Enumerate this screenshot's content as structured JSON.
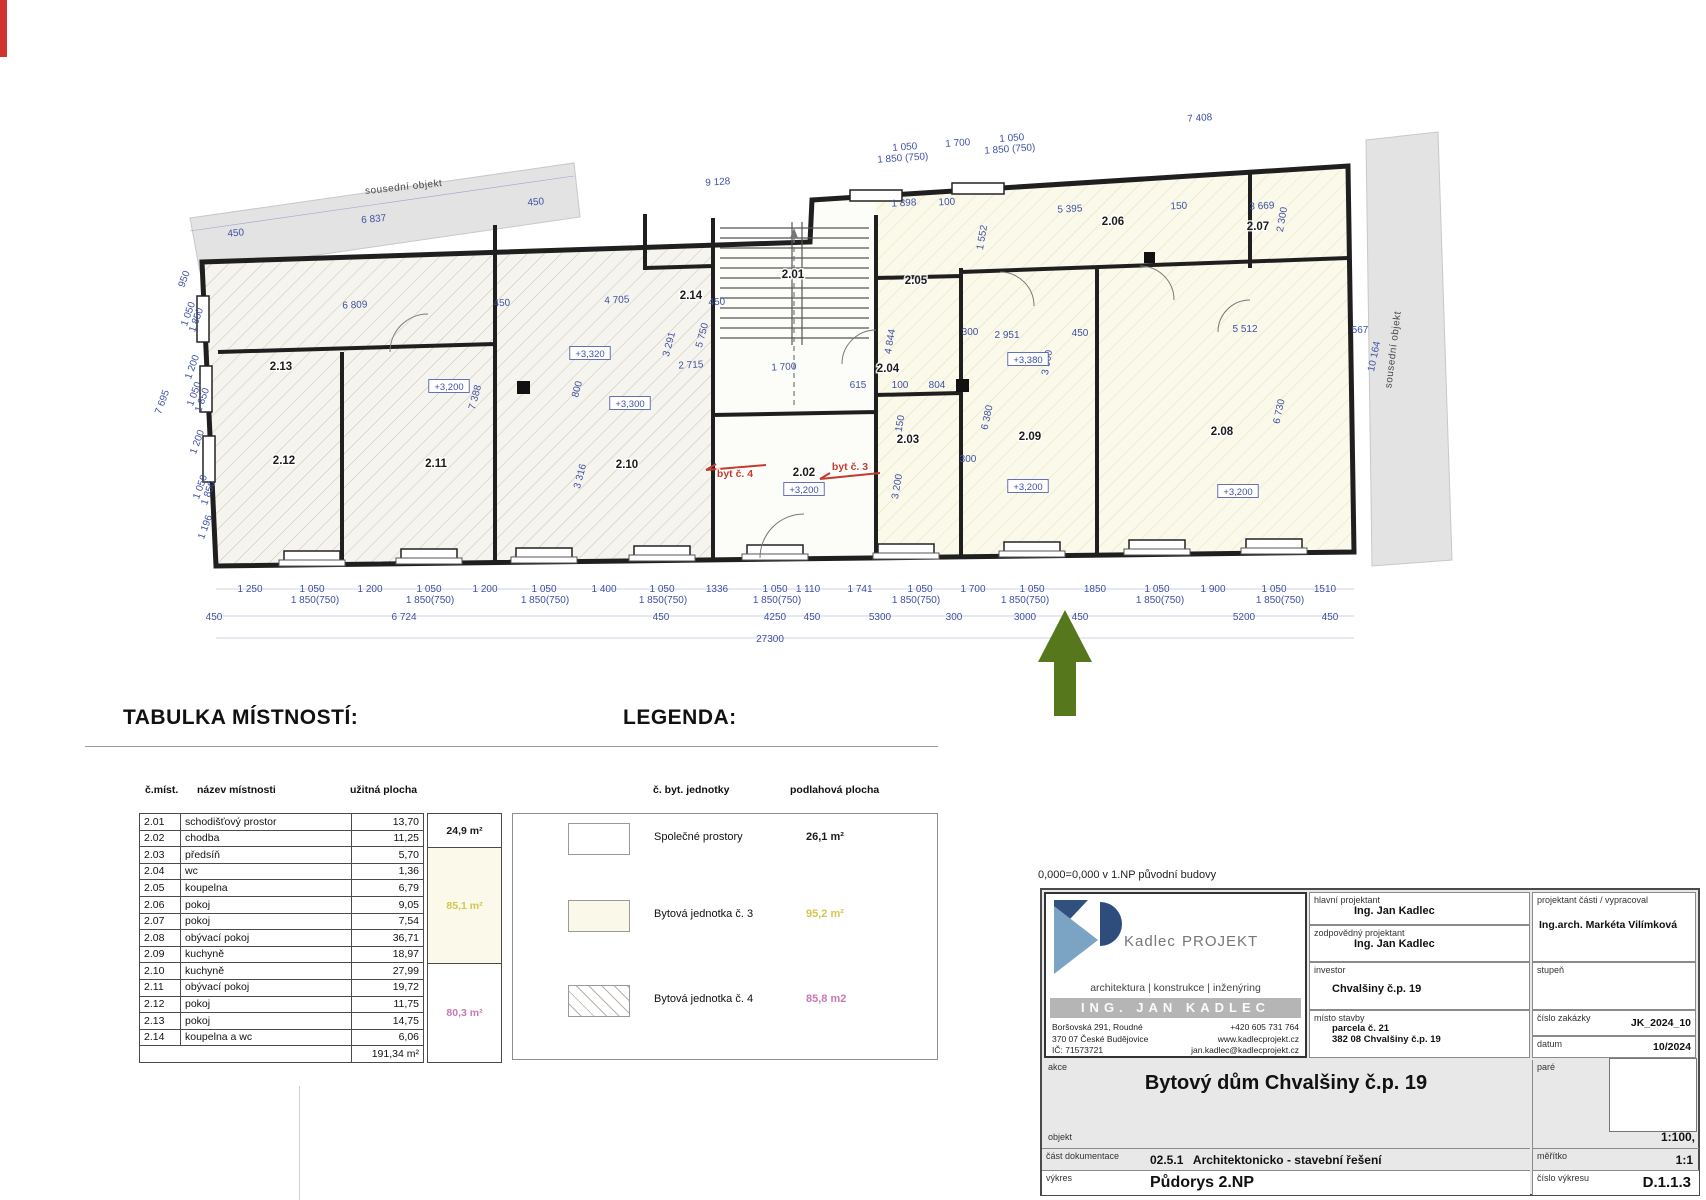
{
  "page": {
    "headings": {
      "table": "TABULKA MÍSTNOSTÍ:",
      "legend": "LEGENDA:"
    },
    "note": "0,000=0,000 v 1.NP původní budovy"
  },
  "plan": {
    "neighbors": [
      {
        "t": "sousední objekt",
        "x": 404,
        "y": 190,
        "r": -6
      },
      {
        "t": "sousední objekt",
        "x": 1396,
        "y": 350,
        "r": -83
      }
    ],
    "rooms": [
      {
        "t": "2.01",
        "x": 793,
        "y": 278
      },
      {
        "t": "2.02",
        "x": 804,
        "y": 476
      },
      {
        "t": "2.03",
        "x": 908,
        "y": 443
      },
      {
        "t": "2.04",
        "x": 888,
        "y": 372
      },
      {
        "t": "2.05",
        "x": 916,
        "y": 284
      },
      {
        "t": "2.06",
        "x": 1113,
        "y": 225
      },
      {
        "t": "2.07",
        "x": 1258,
        "y": 230
      },
      {
        "t": "2.08",
        "x": 1222,
        "y": 435
      },
      {
        "t": "2.09",
        "x": 1030,
        "y": 440
      },
      {
        "t": "2.10",
        "x": 627,
        "y": 468
      },
      {
        "t": "2.11",
        "x": 436,
        "y": 467
      },
      {
        "t": "2.12",
        "x": 284,
        "y": 464
      },
      {
        "t": "2.13",
        "x": 281,
        "y": 370
      },
      {
        "t": "2.14",
        "x": 691,
        "y": 299
      }
    ],
    "elevations": [
      {
        "t": "+3,200",
        "x": 449,
        "y": 390
      },
      {
        "t": "+3,320",
        "x": 590,
        "y": 357
      },
      {
        "t": "+3,300",
        "x": 630,
        "y": 407
      },
      {
        "t": "+3,200",
        "x": 804,
        "y": 493
      },
      {
        "t": "+3,380",
        "x": 1028,
        "y": 363
      },
      {
        "t": "+3,200",
        "x": 1028,
        "y": 490
      },
      {
        "t": "+3,200",
        "x": 1238,
        "y": 495
      }
    ],
    "units": [
      {
        "t": "byt č. 4",
        "x": 735,
        "y": 477
      },
      {
        "t": "byt č. 3",
        "x": 850,
        "y": 470
      }
    ],
    "dims": [
      {
        "t": "450",
        "x": 236,
        "y": 236,
        "r": -5,
        "s": 9
      },
      {
        "t": "6 837",
        "x": 374,
        "y": 222,
        "r": -5
      },
      {
        "t": "450",
        "x": 536,
        "y": 205,
        "r": -5,
        "s": 9
      },
      {
        "t": "9 128",
        "x": 718,
        "y": 185,
        "r": -4
      },
      {
        "t": "1 050",
        "x": 905,
        "y": 150,
        "r": -4,
        "s": 9
      },
      {
        "t": "1 850 (750)",
        "x": 903,
        "y": 161,
        "r": -4,
        "s": 8
      },
      {
        "t": "1 700",
        "x": 958,
        "y": 146,
        "r": -4,
        "s": 9
      },
      {
        "t": "1 050",
        "x": 1012,
        "y": 141,
        "r": -4,
        "s": 9
      },
      {
        "t": "1 850 (750)",
        "x": 1010,
        "y": 152,
        "r": -4,
        "s": 8
      },
      {
        "t": "7 408",
        "x": 1200,
        "y": 121,
        "r": -4
      },
      {
        "t": "1 898",
        "x": 904,
        "y": 206,
        "r": -3,
        "s": 9
      },
      {
        "t": "100",
        "x": 947,
        "y": 205,
        "r": -3,
        "s": 9
      },
      {
        "t": "5 395",
        "x": 1070,
        "y": 212,
        "r": -3
      },
      {
        "t": "150",
        "x": 1179,
        "y": 209,
        "r": -3,
        "s": 9
      },
      {
        "t": "3 669",
        "x": 1262,
        "y": 209,
        "r": -3
      },
      {
        "t": "2 300",
        "x": 1285,
        "y": 220,
        "r": -80,
        "s": 9
      },
      {
        "t": "1 552",
        "x": 985,
        "y": 238,
        "r": -80,
        "s": 9
      },
      {
        "t": "6 809",
        "x": 355,
        "y": 308,
        "r": -3
      },
      {
        "t": "450",
        "x": 502,
        "y": 306,
        "r": -3,
        "s": 9
      },
      {
        "t": "4 705",
        "x": 617,
        "y": 303,
        "r": -3
      },
      {
        "t": "450",
        "x": 717,
        "y": 305,
        "r": -3,
        "s": 9
      },
      {
        "t": "2 715",
        "x": 691,
        "y": 368,
        "r": -3
      },
      {
        "t": "1 700",
        "x": 784,
        "y": 370,
        "r": -3
      },
      {
        "t": "3 291",
        "x": 672,
        "y": 345,
        "r": -75,
        "s": 9
      },
      {
        "t": "5 750",
        "x": 705,
        "y": 336,
        "r": -75,
        "s": 9
      },
      {
        "t": "800",
        "x": 580,
        "y": 390,
        "r": -75,
        "s": 9
      },
      {
        "t": "7 388",
        "x": 478,
        "y": 398,
        "r": -75,
        "s": 9
      },
      {
        "t": "3 316",
        "x": 583,
        "y": 477,
        "r": -75,
        "s": 9
      },
      {
        "t": "615",
        "x": 858,
        "y": 388,
        "s": 9
      },
      {
        "t": "100",
        "x": 900,
        "y": 388,
        "s": 9
      },
      {
        "t": "804",
        "x": 937,
        "y": 388,
        "s": 9
      },
      {
        "t": "150",
        "x": 903,
        "y": 424,
        "r": -80,
        "s": 9
      },
      {
        "t": "4 844",
        "x": 893,
        "y": 342,
        "r": -80,
        "s": 9
      },
      {
        "t": "3 200",
        "x": 900,
        "y": 487,
        "r": -80,
        "s": 9
      },
      {
        "t": "300",
        "x": 970,
        "y": 335,
        "s": 9
      },
      {
        "t": "2 951",
        "x": 1007,
        "y": 338
      },
      {
        "t": "450",
        "x": 1080,
        "y": 336,
        "s": 9
      },
      {
        "t": "3 900",
        "x": 1050,
        "y": 363,
        "r": -80,
        "s": 9
      },
      {
        "t": "5 512",
        "x": 1245,
        "y": 332
      },
      {
        "t": "567",
        "x": 1360,
        "y": 333,
        "s": 9
      },
      {
        "t": "10 164",
        "x": 1377,
        "y": 357,
        "r": -78,
        "s": 9
      },
      {
        "t": "6 730",
        "x": 1282,
        "y": 412,
        "r": -78,
        "s": 9
      },
      {
        "t": "6 380",
        "x": 990,
        "y": 418,
        "r": -78,
        "s": 9
      },
      {
        "t": "300",
        "x": 968,
        "y": 462,
        "s": 9
      },
      {
        "t": "950",
        "x": 187,
        "y": 280,
        "r": -70,
        "s": 9
      },
      {
        "t": "1 050",
        "x": 191,
        "y": 315,
        "r": -70,
        "s": 9
      },
      {
        "t": "1 850",
        "x": 199,
        "y": 321,
        "r": -70,
        "s": 9
      },
      {
        "t": "1 200",
        "x": 195,
        "y": 368,
        "r": -70,
        "s": 9
      },
      {
        "t": "1 050",
        "x": 197,
        "y": 395,
        "r": -70,
        "s": 9
      },
      {
        "t": "1 850",
        "x": 205,
        "y": 401,
        "r": -70,
        "s": 9
      },
      {
        "t": "7 695",
        "x": 165,
        "y": 403,
        "r": -70,
        "s": 9
      },
      {
        "t": "1 200",
        "x": 200,
        "y": 443,
        "r": -70,
        "s": 9
      },
      {
        "t": "1 050",
        "x": 203,
        "y": 488,
        "r": -70,
        "s": 9
      },
      {
        "t": "1 850",
        "x": 211,
        "y": 494,
        "r": -70,
        "s": 9
      },
      {
        "t": "1 196",
        "x": 208,
        "y": 528,
        "r": -70,
        "s": 9
      },
      {
        "t": "1 250",
        "x": 250,
        "y": 592,
        "s": 9.5
      },
      {
        "t": "1 050",
        "x": 312,
        "y": 592,
        "s": 9.5
      },
      {
        "t": "1 200",
        "x": 370,
        "y": 592,
        "s": 9.5
      },
      {
        "t": "1 050",
        "x": 429,
        "y": 592,
        "s": 9.5
      },
      {
        "t": "1 200",
        "x": 485,
        "y": 592,
        "s": 9.5
      },
      {
        "t": "1 050",
        "x": 544,
        "y": 592,
        "s": 9.5
      },
      {
        "t": "1 400",
        "x": 604,
        "y": 592,
        "s": 9.5
      },
      {
        "t": "1 050",
        "x": 662,
        "y": 592,
        "s": 9.5
      },
      {
        "t": "1336",
        "x": 717,
        "y": 592,
        "s": 9.5
      },
      {
        "t": "1 050",
        "x": 775,
        "y": 592,
        "s": 9.5
      },
      {
        "t": "1 110",
        "x": 808,
        "y": 592,
        "s": 9.5
      },
      {
        "t": "1 741",
        "x": 860,
        "y": 592,
        "s": 9.5
      },
      {
        "t": "1 050",
        "x": 920,
        "y": 592,
        "s": 9.5
      },
      {
        "t": "1 700",
        "x": 973,
        "y": 592,
        "s": 9.5
      },
      {
        "t": "1 050",
        "x": 1032,
        "y": 592,
        "s": 9.5
      },
      {
        "t": "1850",
        "x": 1095,
        "y": 592,
        "s": 9.5
      },
      {
        "t": "1 050",
        "x": 1157,
        "y": 592,
        "s": 9.5
      },
      {
        "t": "1 900",
        "x": 1213,
        "y": 592,
        "s": 9.5
      },
      {
        "t": "1 050",
        "x": 1274,
        "y": 592,
        "s": 9.5
      },
      {
        "t": "1510",
        "x": 1325,
        "y": 592,
        "s": 9.5
      },
      {
        "t": "1 850(750)",
        "x": 315,
        "y": 603,
        "s": 8
      },
      {
        "t": "1 850(750)",
        "x": 430,
        "y": 603,
        "s": 8
      },
      {
        "t": "1 850(750)",
        "x": 545,
        "y": 603,
        "s": 8
      },
      {
        "t": "1 850(750)",
        "x": 663,
        "y": 603,
        "s": 8
      },
      {
        "t": "1 850(750)",
        "x": 777,
        "y": 603,
        "s": 8
      },
      {
        "t": "1 850(750)",
        "x": 916,
        "y": 603,
        "s": 8
      },
      {
        "t": "1 850(750)",
        "x": 1025,
        "y": 603,
        "s": 8
      },
      {
        "t": "1 850(750)",
        "x": 1160,
        "y": 603,
        "s": 8
      },
      {
        "t": "1 850(750)",
        "x": 1280,
        "y": 603,
        "s": 8
      },
      {
        "t": "450",
        "x": 214,
        "y": 620,
        "s": 9.5
      },
      {
        "t": "6 724",
        "x": 404,
        "y": 620,
        "s": 9.5
      },
      {
        "t": "450",
        "x": 661,
        "y": 620,
        "s": 9.5
      },
      {
        "t": "4250",
        "x": 775,
        "y": 620,
        "s": 9.5
      },
      {
        "t": "450",
        "x": 812,
        "y": 620,
        "s": 9
      },
      {
        "t": "5300",
        "x": 880,
        "y": 620,
        "s": 9.5
      },
      {
        "t": "300",
        "x": 954,
        "y": 620,
        "s": 9.5
      },
      {
        "t": "3000",
        "x": 1025,
        "y": 620,
        "s": 9.5
      },
      {
        "t": "450",
        "x": 1080,
        "y": 620,
        "s": 9.5
      },
      {
        "t": "5200",
        "x": 1244,
        "y": 620,
        "s": 9.5
      },
      {
        "t": "450",
        "x": 1330,
        "y": 620,
        "s": 9.5
      },
      {
        "t": "27300",
        "x": 770,
        "y": 642,
        "s": 9.5
      }
    ]
  },
  "table": {
    "headers": [
      "č.míst.",
      "název místnosti",
      "užitná plocha"
    ],
    "rows": [
      [
        "2.01",
        "schodišťový prostor",
        "13,70"
      ],
      [
        "2.02",
        "chodba",
        "11,25"
      ],
      [
        "2.03",
        "předsíň",
        "5,70"
      ],
      [
        "2.04",
        "wc",
        "1,36"
      ],
      [
        "2.05",
        "koupelna",
        "6,79"
      ],
      [
        "2.06",
        "pokoj",
        "9,05"
      ],
      [
        "2.07",
        "pokoj",
        "7,54"
      ],
      [
        "2.08",
        "obývací pokoj",
        "36,71"
      ],
      [
        "2.09",
        "kuchyně",
        "18,97"
      ],
      [
        "2.10",
        "kuchyně",
        "27,99"
      ],
      [
        "2.11",
        "obývací pokoj",
        "19,72"
      ],
      [
        "2.12",
        "pokoj",
        "11,75"
      ],
      [
        "2.13",
        "pokoj",
        "14,75"
      ],
      [
        "2.14",
        "koupelna a wc",
        "6,06"
      ]
    ],
    "total": "191,34 m²",
    "groups": [
      {
        "label": "24,9 m²",
        "color": "#1a1a1a",
        "bg": "#ffffff"
      },
      {
        "label": "85,1 m²",
        "color": "#d2c64e",
        "bg": "#fbf9e9"
      },
      {
        "label": "80,3 m²",
        "color": "#c878b4",
        "bg": "#ffffff"
      }
    ]
  },
  "legend": {
    "headers": [
      "č. byt. jednotky",
      "podlahová plocha"
    ],
    "rows": [
      {
        "label": "Společné prostory",
        "area": "26,1 m²",
        "color": "#1a1a1a"
      },
      {
        "label": "Bytová jednotka č. 3",
        "area": "95,2 m²",
        "color": "#d2c64e"
      },
      {
        "label": "Bytová jednotka č. 4",
        "area": "85,8 m2",
        "color": "#c878b4"
      }
    ]
  },
  "titleblock": {
    "logo": {
      "brand": "Kadlec",
      "brand_suffix": "PROJEKT",
      "tagline": "architektura  |  konstrukce  |  inženýring",
      "name": "ING. JAN KADLEC",
      "addr1": "Boršovská 291, Roudné",
      "addr2": "370 07 České Budějovice",
      "addr3": "IČ:  71573721",
      "phone": "+420 605 731 764",
      "web": "www.kadlecprojekt.cz",
      "email": "jan.kadlec@kadlecprojekt.cz"
    },
    "hlavni_label": "hlavní projektant",
    "hlavni_value": "Ing. Jan Kadlec",
    "zodpovedny_label": "zodpovědný projektant",
    "zodpovedny_value": "Ing. Jan Kadlec",
    "investor_label": "investor",
    "investor_value": "Chvalšiny č.p. 19",
    "misto_label": "místo stavby",
    "misto_value1": "parcela č. 21",
    "misto_value2": "382 08 Chvalšiny č.p. 19",
    "proj_casti_label": "projektant části / vypracoval",
    "proj_casti_value": "Ing.arch. Markéta Vilímková",
    "stupen_label": "stupeň",
    "zakazka_label": "číslo zakázky",
    "zakazka_value": "JK_2024_10",
    "datum_label": "datum",
    "datum_value": "10/2024",
    "pare_label": "paré",
    "akce_label": "akce",
    "akce_value": "Bytový dům Chvalšiny č.p. 19",
    "objekt_label": "objekt",
    "cast_label": "část dokumentace",
    "cast_value": "02.5.1   Architektonicko - stavební řešení",
    "vykres_label": "výkres",
    "vykres_value": "Půdorys 2.NP",
    "meritko_label": "měřítko",
    "meritko_note": "1:100,",
    "meritko_value": "1:1",
    "cislo_label": "číslo výkresu",
    "cislo_value": "D.1.1.3"
  }
}
